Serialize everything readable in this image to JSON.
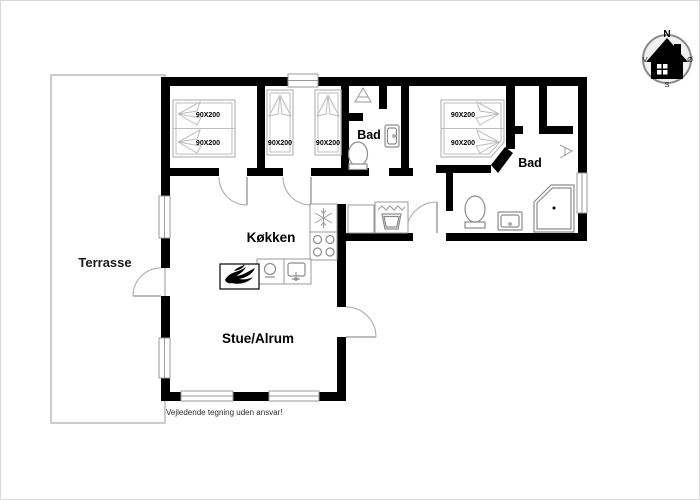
{
  "plan": {
    "disclaimer": "Vejledende tegning uden ansvar!",
    "rooms": {
      "terrace": {
        "label": "Terrasse"
      },
      "kitchen": {
        "label": "Køkken"
      },
      "living": {
        "label": "Stue/Alrum"
      },
      "bath1": {
        "label": "Bad"
      },
      "bath2": {
        "label": "Bad"
      }
    },
    "beds": {
      "size": "90X200"
    },
    "compass": {
      "north": "N",
      "west": "V",
      "east": "Ø",
      "south": "S"
    },
    "colors": {
      "wall": "#000000",
      "fixture_outline": "#8c8c8c",
      "paper": "#ffffff"
    }
  }
}
